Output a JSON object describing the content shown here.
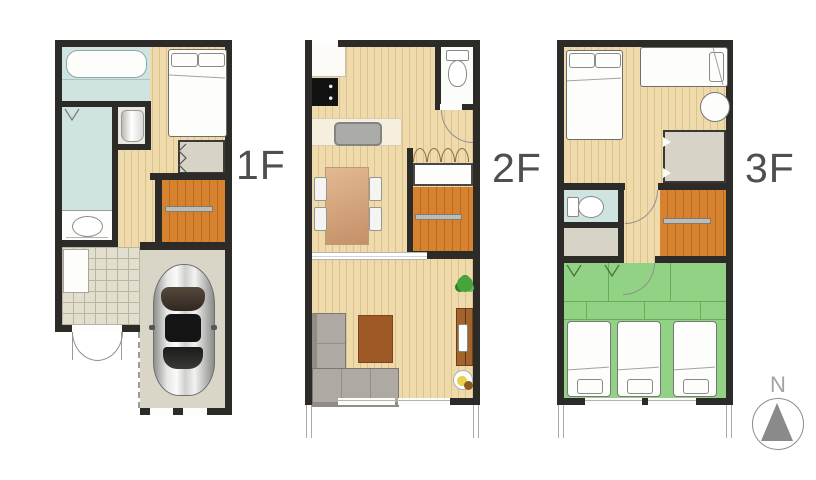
{
  "floors": [
    {
      "label": "1F",
      "features": [
        "bathroom-bathtub",
        "washroom",
        "washing-machine",
        "vanity-basin",
        "double-bed",
        "closet",
        "staircase",
        "entrance-tiled-floor",
        "shoe-cabinet",
        "double-entry-door",
        "garage",
        "car"
      ]
    },
    {
      "label": "2F",
      "features": [
        "refrigerator-space",
        "cooktop",
        "kitchen-counter-sink",
        "toilet",
        "folding-door-closet",
        "staircase",
        "dining-table-four-chairs",
        "sliding-partition",
        "l-shaped-sofa",
        "coffee-table",
        "plant",
        "tv-board",
        "tv",
        "floor-lamp",
        "balcony"
      ]
    },
    {
      "label": "3F",
      "features": [
        "double-bed",
        "single-bed",
        "round-stool",
        "closet",
        "toilet",
        "storage",
        "staircase",
        "tatami-room",
        "three-futons",
        "balcony"
      ]
    }
  ],
  "compass": {
    "label": "N"
  },
  "palette": {
    "wall": "#2d2b28",
    "wood": "#eedaab",
    "wood-line": "#dcc28d",
    "stair": "#d6822f",
    "stair-line": "#b96a22",
    "water-blue": "#cfe4e0",
    "tatami-green": "#92d284",
    "tatami-line": "#68ad58",
    "closet-grey": "#d7d4c7",
    "garage-floor": "#d9d6c8",
    "tile": "#e3dfcf",
    "label-grey": "#4f4f4f",
    "compass-grey": "#8a8a8a"
  }
}
